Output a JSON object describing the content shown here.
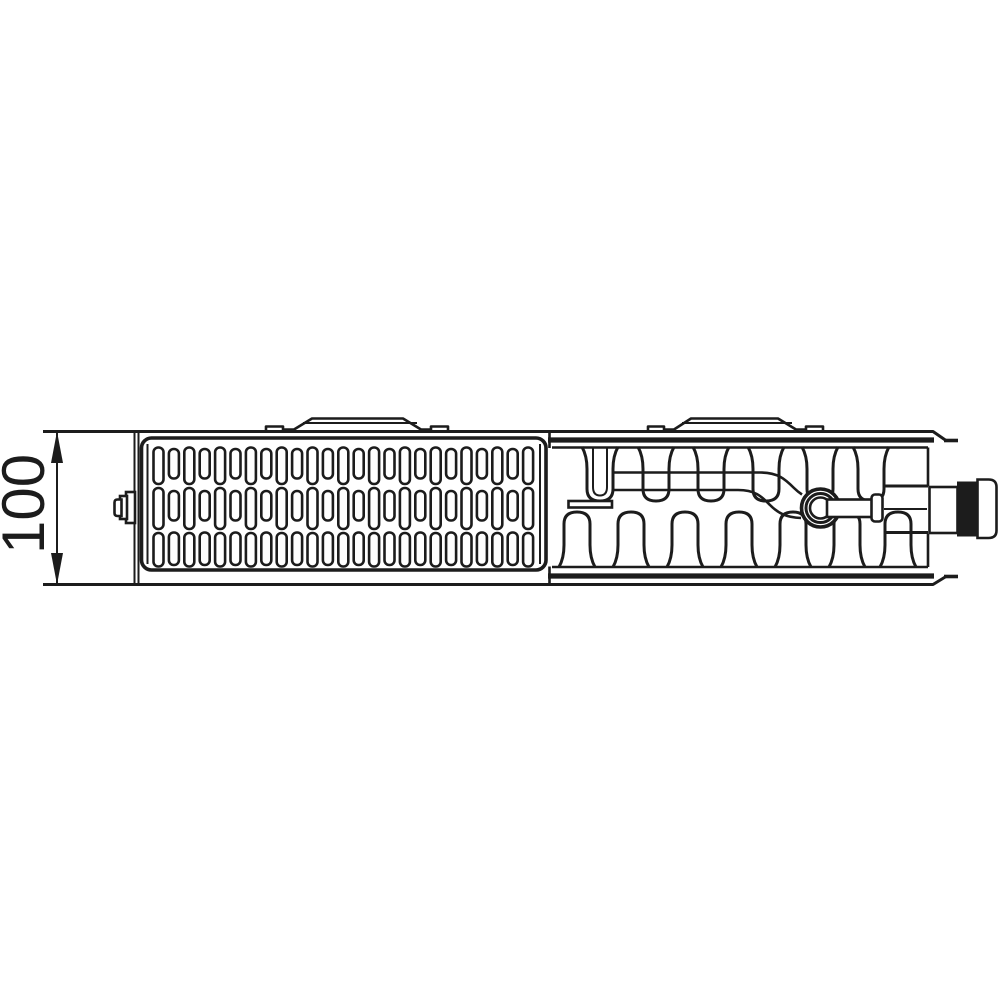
{
  "colors": {
    "background": "#ffffff",
    "ink": "#1c1c1c"
  },
  "dimension": {
    "label": "100"
  },
  "figure": {
    "type": "radiator-top-section-drawing",
    "grille": {
      "columns": 25,
      "col_start": 153.5,
      "col_pitch": 15.4,
      "slot_width": 10,
      "even_slots": [
        [
          447.5,
          484
        ],
        [
          488,
          529
        ],
        [
          533,
          566.5
        ]
      ],
      "odd_slots": [
        [
          449,
          478.5
        ],
        [
          491,
          520.5
        ],
        [
          532.5,
          565
        ]
      ]
    },
    "fins": {
      "top_centers": [
        656,
        711,
        766,
        820,
        871
      ],
      "bottom_centers": [
        577,
        631,
        685,
        739,
        793,
        847,
        898
      ],
      "special_top_center": 600
    }
  }
}
